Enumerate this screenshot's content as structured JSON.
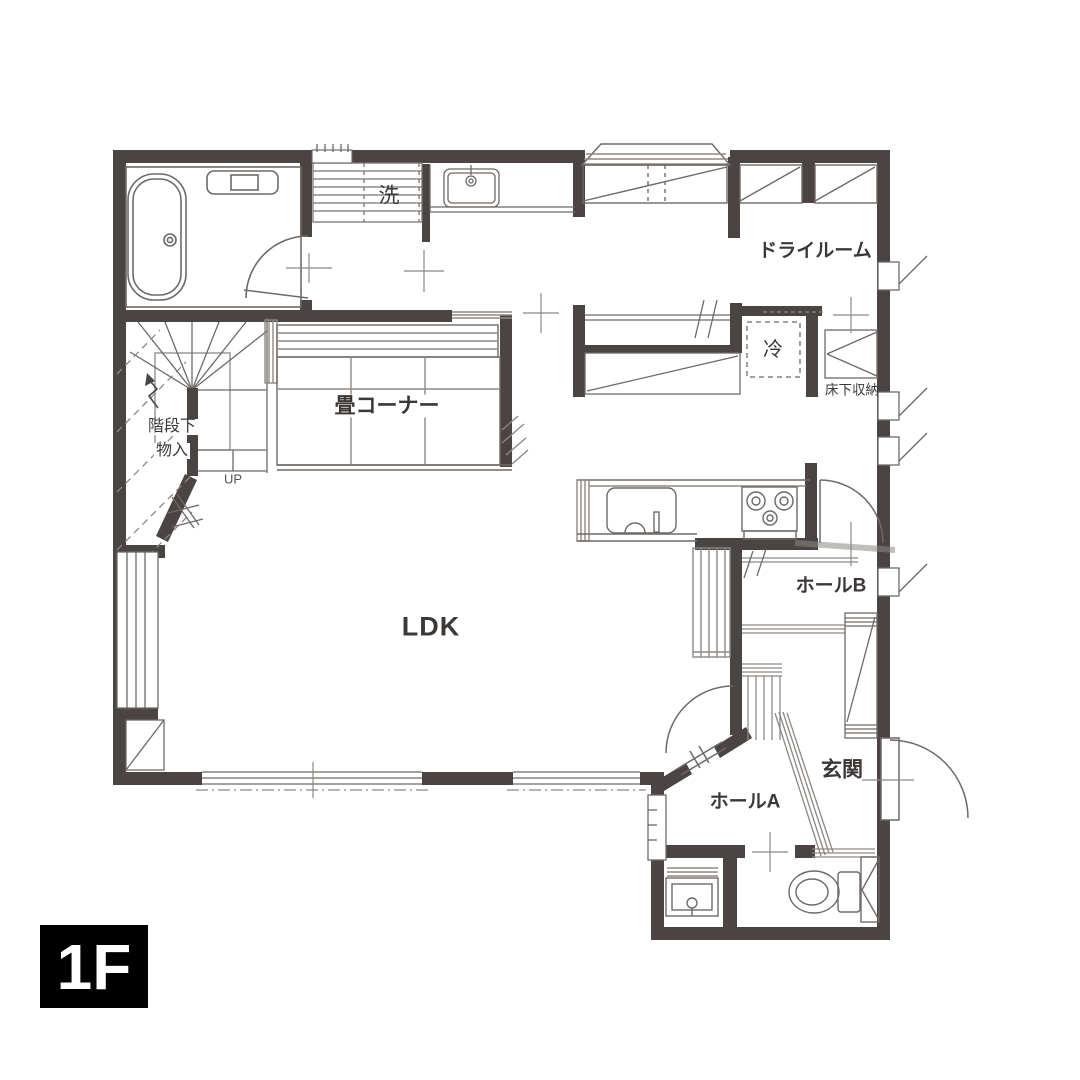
{
  "floor_badge": "1F",
  "rooms": {
    "ldk": "LDK",
    "tatami_corner": "畳コーナー",
    "dry_room": "ドライルーム",
    "hall_a": "ホールA",
    "hall_b": "ホールB",
    "entrance": "玄関",
    "washer": "洗",
    "fridge": "冷",
    "underfloor_storage": "床下収納",
    "under_stairs_line1": "階段下",
    "under_stairs_line2": "物入",
    "stairs_direction": "UP"
  },
  "colors": {
    "wall": "#4a4543",
    "line": "#6e6966",
    "hatch": "#8d8884",
    "text": "#3c3836",
    "badge_bg": "#000000",
    "badge_text": "#ffffff",
    "background": "#ffffff"
  }
}
